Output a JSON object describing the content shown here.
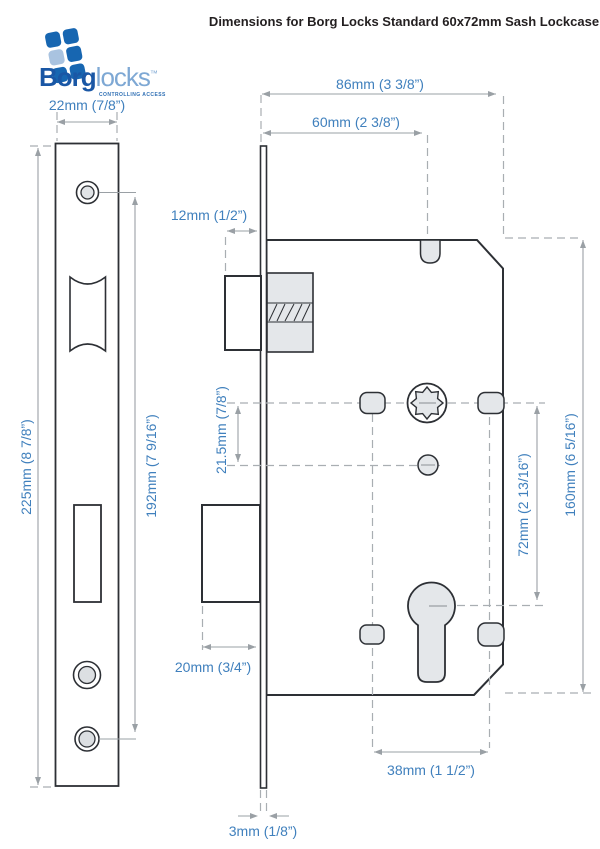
{
  "header": {
    "title": "Dimensions for Borg Locks Standard 60x72mm Sash Lockcase"
  },
  "logo": {
    "brand_bold": "Borg",
    "brand_light": "locks",
    "trademark": "™",
    "tagline": "CONTROLLING ACCESS"
  },
  "dimensions": {
    "faceplate_width": "22mm (7/8”)",
    "case_overall_width": "86mm (3 3/8”)",
    "backset": "60mm (2 3/8”)",
    "latch_projection": "12mm (1/2”)",
    "faceplate_height": "225mm (8 7/8”)",
    "screw_hole_centres": "192mm (7 9/16”)",
    "follower_to_hole": "21.5mm (7/8”)",
    "deadbolt_throw": "20mm (3/4”)",
    "lock_centres": "72mm (2 13/16”)",
    "case_height": "160mm (6 5/16”)",
    "fixing_hole_centres": "38mm (1 1/2”)",
    "faceplate_thickness": "3mm (1/8”)"
  },
  "colors": {
    "dimension_text": "#4080bd",
    "dimension_line": "#9aa0a5",
    "outline": "#2d3035",
    "component_fill": "#e4e7ea",
    "brand_dark_blue": "#1a57a5",
    "brand_light_blue": "#7ea8d4"
  }
}
